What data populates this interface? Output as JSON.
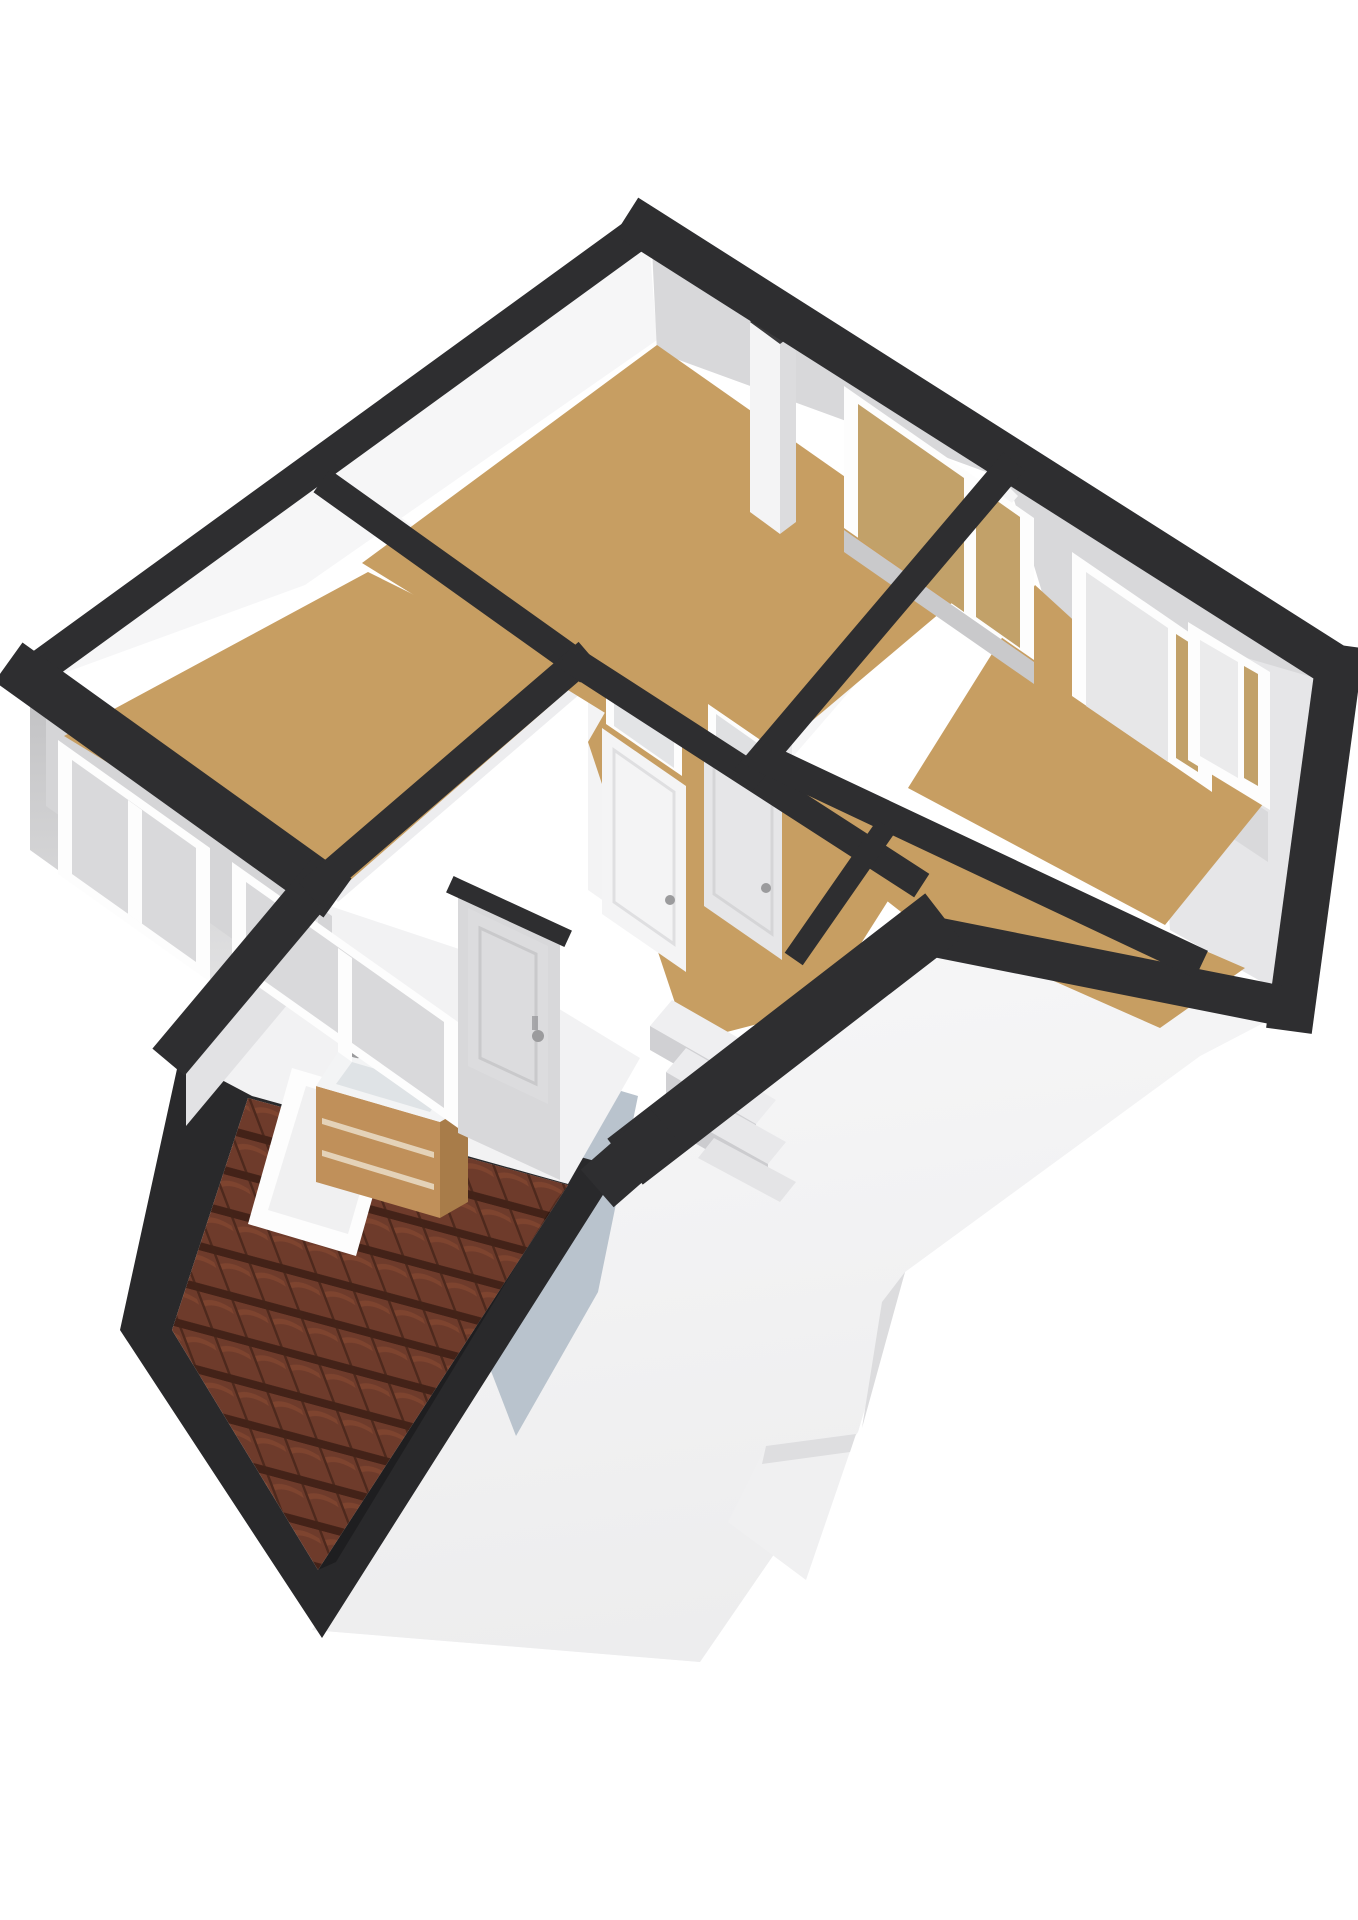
{
  "scene": {
    "kind": "3d-floorplan-render",
    "view": "isometric-top",
    "rooms": [
      {
        "id": "bedroom-large",
        "floor": "tan",
        "windows_top_wall": 1,
        "has_chimney_pier": true
      },
      {
        "id": "bedroom-left",
        "floor": "tan",
        "windows_exterior_wall": 2
      },
      {
        "id": "bedroom-right",
        "floor": "tan",
        "windows": 2,
        "has_curtain_window": true
      },
      {
        "id": "closet",
        "floor": "tan",
        "doors": 1
      },
      {
        "id": "hallway",
        "floor": "tan",
        "doors_with_transom": 2,
        "has_staircase": true
      },
      {
        "id": "bathroom",
        "floor": "blue-gray",
        "fixtures": [
          "sink-vanity",
          "skylight-window",
          "sloped-ceiling"
        ],
        "doors": 1
      }
    ],
    "exterior": {
      "roof_tiles": true,
      "roof_frame": true,
      "facade_right": "white",
      "facade_left": "gray",
      "gable_notch": true
    },
    "fixtures": [
      "staircase-4-steps",
      "sink-vanity-wood",
      "skylight-frame",
      "chimney-pier",
      "door-handles"
    ]
  },
  "colors": {
    "wall_cap": "#2e2e30",
    "wall_cap_soft": "#3a3a3c",
    "ring_dark": "#29292b",
    "wall_white": "#f6f6f7",
    "wall_light": "#ededef",
    "wall_gray": "#d8d8da",
    "wall_deep": "#c3c3c5",
    "frame_white": "#fdfdfd",
    "floor_tan": "#c79e62",
    "floor_tan_light": "#d3ab6e",
    "floor_bath": "#b9c3cd",
    "glass_tan": "#c2a169",
    "glass_gray": "#d9d9db",
    "curtain": "#ebebec",
    "facade_white": "#f5f5f6",
    "facade_shade": "#e2e2e4",
    "facade_gray": "#c6c6c8",
    "facade_gray_light": "#e6e6e7",
    "tile_base": "#6e3b2b",
    "tile_dark": "#432218",
    "tile_mid": "#8a4b33",
    "wood": "#c0905a",
    "wood_dark": "#a87c49",
    "metal": "#9b9b9d",
    "sink_white": "#f3f4f5",
    "step_light": "#efeff1",
    "step_riser": "#d0d0d3"
  }
}
